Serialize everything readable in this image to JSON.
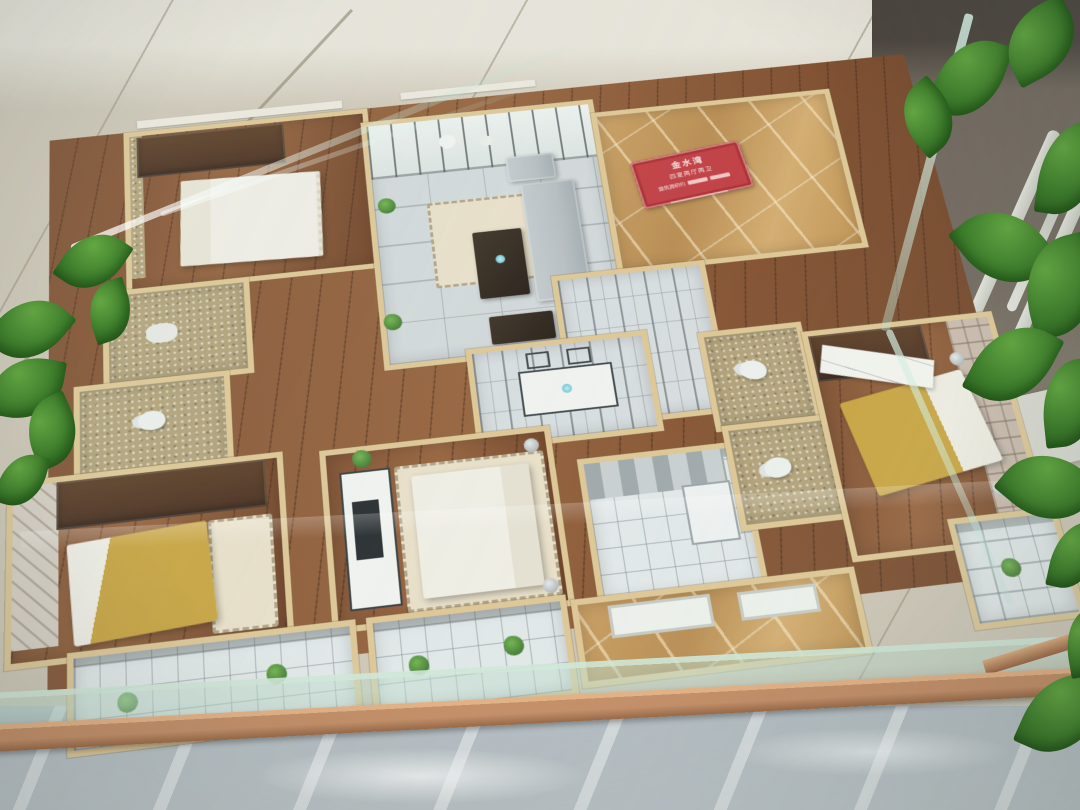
{
  "meta": {
    "subject": "Miniature four-bedroom apartment floor-plan scale model displayed inside a glass case",
    "setting": "Sales-office corner: beige tiled wall behind, grey polished marble floor below, white ladder shelf and green pothos plant at right, copper trim on case base"
  },
  "sign": {
    "title": "金水湾",
    "subtitle": "四室两厅两卫",
    "area_label": "建筑面积约",
    "area_unit": "㎡"
  },
  "rooms": [
    "bedroom-top-left",
    "bathroom-mosaic-1",
    "bathroom-mosaic-2",
    "bedroom-left-gold",
    "living-room",
    "entry-hall-marble",
    "hallway-lineart",
    "dining-area",
    "bedroom-middle-white",
    "kitchen",
    "bathroom-center-1",
    "bathroom-center-2",
    "master-bedroom",
    "balcony-1",
    "balcony-2",
    "balcony-marble",
    "balcony-corner"
  ],
  "palette": {
    "wall-tile": "#cec5b5",
    "wall-line": "#b6ac9b",
    "upper-wall": "#e9e4da",
    "dark-panel": "#6e6359",
    "dark-deep": "#453d36",
    "leaf": "#4e8f35",
    "leaf-dark": "#2e6123",
    "white-wood": "#d9d8d0",
    "glass": "#bfe2d2",
    "model-wall": "#dfc694",
    "wood": "#7c4a2b",
    "wood-light": "#96603a",
    "living-floor": "#d3d8da",
    "lineart": "#6d7478",
    "marble": "#c69a5c",
    "marble-vein": "#efddb2",
    "mosaic": "#b2a077",
    "white-tile": "#e3e8e9",
    "tile-line": "#a2acb0",
    "gray-floor": "#b2bac0",
    "copper": "#c3906a",
    "copper-dark": "#9a6a48",
    "sign-red": "#c13a40",
    "sign-ink": "#f7e3de",
    "bed-white": "#f1eee6",
    "bed-gold": "#c9a23d",
    "furn-dark": "#46291a",
    "sofa": "#b7bdc2",
    "rug": "#eadfc8",
    "brick": "#c9b9ab",
    "paper": "#f4f3ee"
  }
}
